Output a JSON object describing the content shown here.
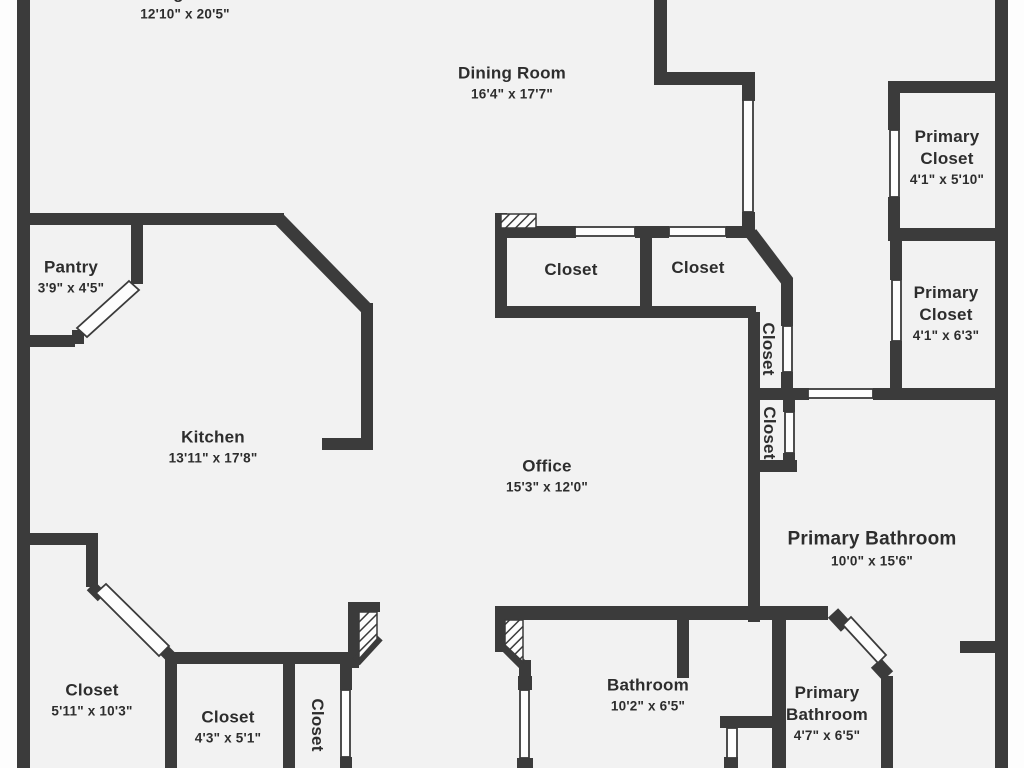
{
  "plan": {
    "type": "floor-plan",
    "colors": {
      "wall": "#3b3b3b",
      "floor": "#f2f2f2",
      "outside": "#ffffff",
      "text": "#2d2d2d",
      "door_gap": "#fdfdfd"
    },
    "rooms": [
      {
        "name": "Living Room",
        "dims": "12'10\" x 20'5\""
      },
      {
        "name": "Dining Room",
        "dims": "16'4\" x 17'7\""
      },
      {
        "name": "Primary Closet",
        "dims": "4'1\" x 5'10\""
      },
      {
        "name": "Pantry",
        "dims": "3'9\" x 4'5\""
      },
      {
        "name": "Closet"
      },
      {
        "name": "Closet"
      },
      {
        "name": "Primary Closet",
        "dims": "4'1\" x 6'3\""
      },
      {
        "name": "Closet"
      },
      {
        "name": "Closet"
      },
      {
        "name": "Kitchen",
        "dims": "13'11\" x 17'8\""
      },
      {
        "name": "Office",
        "dims": "15'3\" x 12'0\""
      },
      {
        "name": "Primary Bathroom",
        "dims": "10'0\" x 15'6\""
      },
      {
        "name": "Closet",
        "dims": "5'11\" x 10'3\""
      },
      {
        "name": "Closet",
        "dims": "4'3\" x 5'1\""
      },
      {
        "name": "Closet"
      },
      {
        "name": "Bathroom",
        "dims": "10'2\" x 6'5\""
      },
      {
        "name": "Primary Bathroom",
        "dims": "4'7\" x 6'5\""
      }
    ]
  }
}
